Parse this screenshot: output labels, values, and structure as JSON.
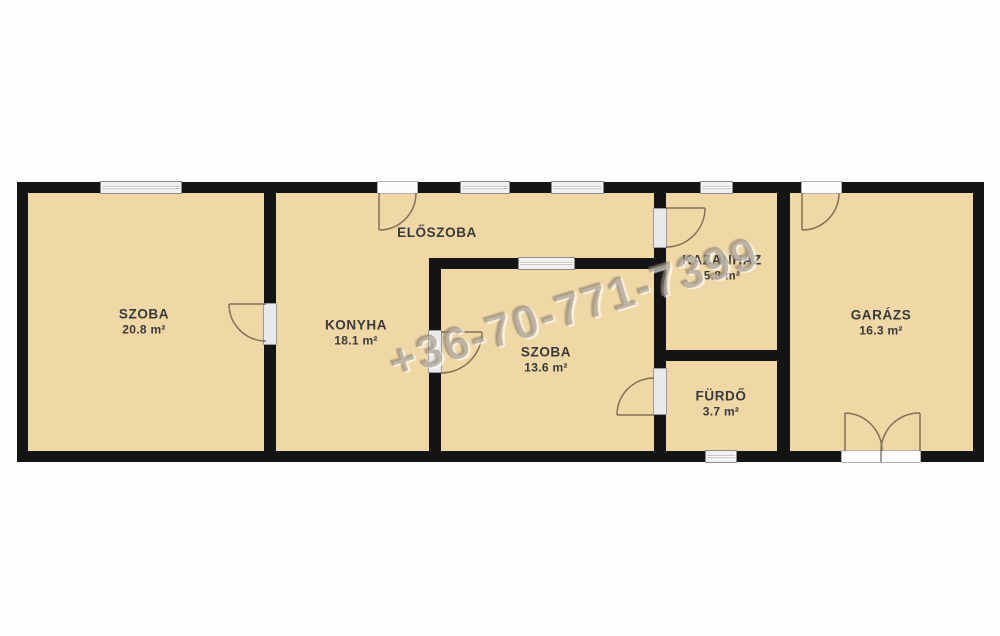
{
  "watermark": "+36-70-771-7399",
  "rooms": [
    {
      "id": "szoba-1",
      "name": "SZOBA",
      "area": "20.8 m²"
    },
    {
      "id": "konyha",
      "name": "KONYHA",
      "area": "18.1 m²"
    },
    {
      "id": "eloszoba",
      "name": "ELŐSZOBA"
    },
    {
      "id": "szoba-2",
      "name": "SZOBA",
      "area": "13.6 m²"
    },
    {
      "id": "kazanhaz",
      "name": "KAZÁNHÁZ",
      "area": "5.8 m²"
    },
    {
      "id": "furdo",
      "name": "FÜRDŐ",
      "area": "3.7 m²"
    },
    {
      "id": "garazs",
      "name": "GARÁZS",
      "area": "16.3 m²"
    }
  ],
  "colors": {
    "floor": "#f0d7a6",
    "wall": "#141414",
    "door_arc": "#77674f",
    "label_text": "#3a3a3a",
    "watermark": "#97836e"
  }
}
